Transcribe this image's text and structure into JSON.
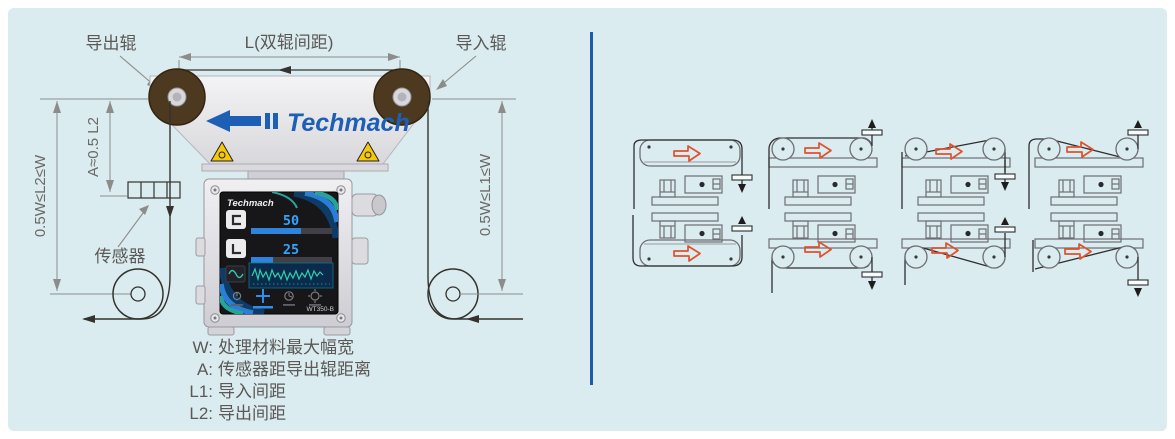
{
  "colors": {
    "panel_bg": "#daecef",
    "divider": "#1b5ca6",
    "brand_blue": "#1d5fb5",
    "schematic_arrow": "#e0512c"
  },
  "diagram": {
    "label_outfeed_roller": "导出辊",
    "label_infeed_roller": "导入辊",
    "label_roller_spacing": "L(双辊间距)",
    "label_sensor": "传感器",
    "dim_l2": "0.5W≤L2≤W",
    "dim_a": "A≈0.5 L2",
    "dim_l1": "0.5W≤L1≤W",
    "brand": "Techmach"
  },
  "display": {
    "brand": "Techmach",
    "value_top": "50",
    "value_bottom": "25",
    "model": "WT350-B"
  },
  "legend": [
    {
      "key": "W:",
      "text": "处理材料最大幅宽"
    },
    {
      "key": "A:",
      "text": "传感器距导出辊距离"
    },
    {
      "key": "L1:",
      "text": "导入间距"
    },
    {
      "key": "L2:",
      "text": "导出间距"
    }
  ]
}
